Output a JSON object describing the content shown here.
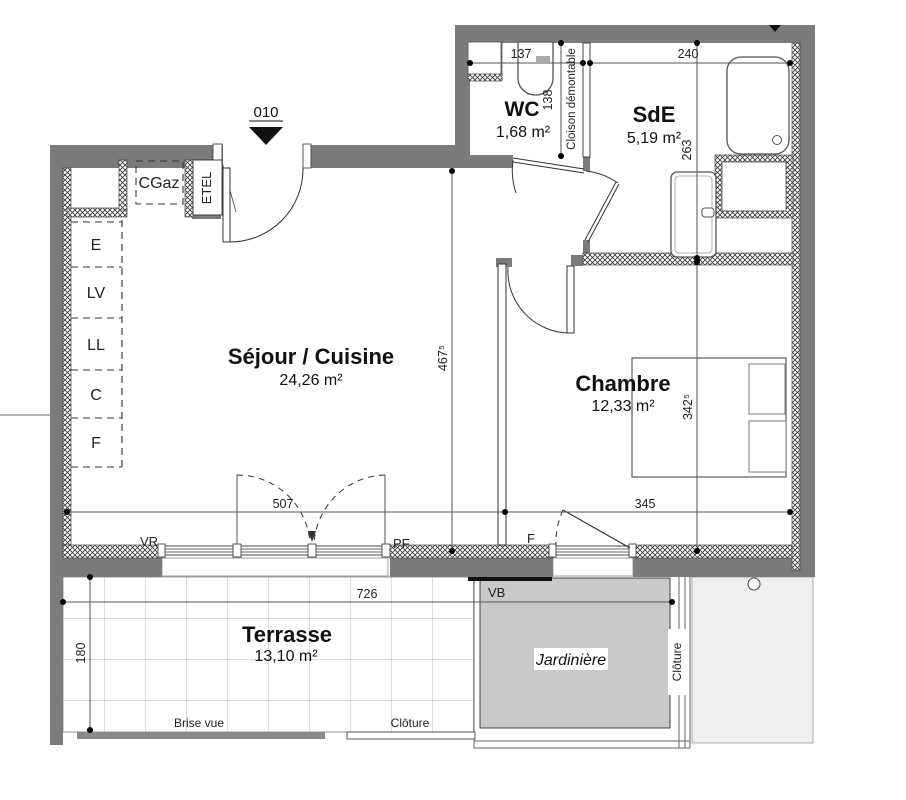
{
  "plan": {
    "unit_marker": "010",
    "rooms": {
      "wc": {
        "name": "WC",
        "area": "1,68 m²"
      },
      "sde": {
        "name": "SdE",
        "area": "5,19 m²"
      },
      "sejour": {
        "name": "Séjour / Cuisine",
        "area": "24,26 m²"
      },
      "chambre": {
        "name": "Chambre",
        "area": "12,33 m²"
      },
      "terrasse": {
        "name": "Terrasse",
        "area": "13,10 m²"
      },
      "jardiniere": {
        "name": "Jardinière"
      }
    },
    "dimensions_cm": {
      "wc_width": "137",
      "wc_depth": "138",
      "sde_width": "240",
      "sde_depth": "263",
      "sejour_depth": "467⁵",
      "chambre_depth": "342⁵",
      "sejour_width": "507",
      "chambre_width": "345",
      "terrasse_width": "726",
      "terrasse_depth": "180"
    },
    "labels": {
      "cloison": "Cloison démontable",
      "vr": "VR",
      "pf": "PF",
      "fenetre": "F",
      "vb": "VB",
      "brise_vue": "Brise vue",
      "cloture_bas": "Clôture",
      "cloture_droite": "Clôture",
      "cgaz": "CGaz",
      "etel": "ETEL"
    },
    "appliances": [
      "E",
      "LV",
      "LL",
      "C",
      "F"
    ],
    "colors": {
      "wall": "#7b7b7b",
      "jardiniere_fill": "#c9c9c9",
      "neighbor_fill": "#efefef"
    }
  }
}
